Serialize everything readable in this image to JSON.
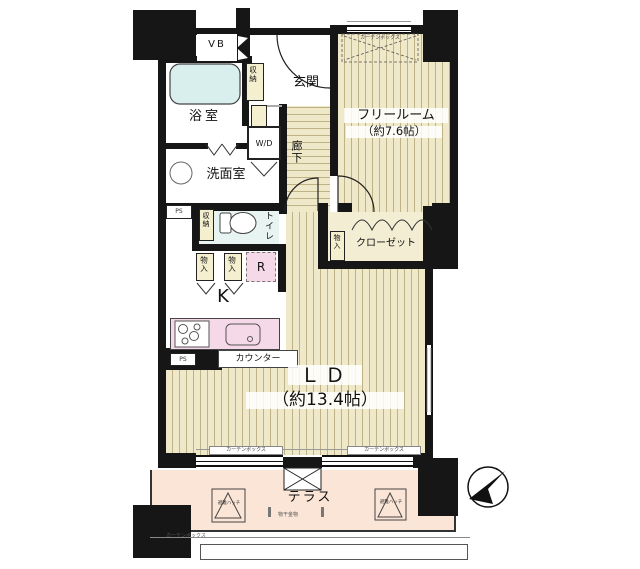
{
  "floorplan": {
    "rooms": {
      "vb": "VB",
      "bathroom": "浴室",
      "washroom": "洗面室",
      "entrance": "玄関",
      "hallway": "廊下",
      "free_room": "フリールーム",
      "free_room_size": "（約7.6帖）",
      "closet": "クローゼット",
      "toilet": "トイレ",
      "kitchen": "K",
      "living_dining": "ＬＤ",
      "living_dining_size": "（約13.4帖）",
      "terrace": "テラス"
    },
    "fixtures": {
      "washer_dryer": "W/D",
      "refrigerator": "R",
      "counter": "カウンター",
      "storage": "収納",
      "cabinet": "物入",
      "pipe_space": "PS",
      "curtain_box": "カーテンボックス",
      "escape_hatch": "避難ハッチ",
      "laundry_bracket": "物干金物"
    },
    "colors": {
      "wall": "#161616",
      "wood_floor": "#efe8c9",
      "tub": "#d9efed",
      "toilet_room": "#e8f4f1",
      "kitchen_pink": "#f6d9e8",
      "terrace_pink": "#fbe5d6",
      "storage_yellow": "#f4efcf"
    }
  }
}
